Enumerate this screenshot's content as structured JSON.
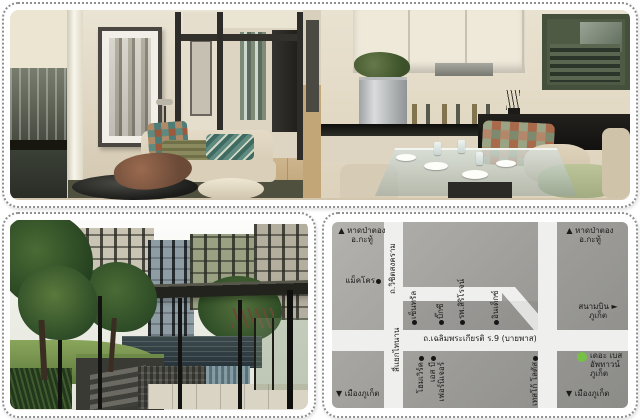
{
  "map": {
    "directions": {
      "top_left": [
        "▲ หาดป่าตอง",
        "อ.กะทู้"
      ],
      "top_right": [
        "▲ หาดป่าตอง",
        "อ.กะทู้"
      ],
      "bottom_left": "▼ เมืองภูเก็ต",
      "bottom_right": "▼ เมืองภูเก็ต",
      "airport": [
        "สนามบิน ►",
        "ภูเก็ต"
      ]
    },
    "roads": {
      "vertical": "ถ.วิชิตสงคราม",
      "main": "ถ.เฉลิมพระเกียรติ ร.9 (บายพาส)",
      "intersection": "สี่แยกไทนาน"
    },
    "poi": {
      "makro": "แม็คโคร",
      "central": "เซ็นทรัล",
      "bigc": "บิ๊กซี",
      "siriroj": "รพ.สิริโรจน์",
      "index": "อินเด็กซ์",
      "homework": "โฮมเวิร์ค",
      "sb_furniture": [
        "เอส บี",
        "เฟอร์นิเจอร์"
      ],
      "tesco": "เทสโก้ โลตัส"
    },
    "project": {
      "name_lines": [
        "เดอะ เบส",
        "อัพทาวน์",
        "ภูเก็ต"
      ],
      "marker_color": "#76c043"
    },
    "colors": {
      "map_background": "#9c9b98",
      "road": "#efefed",
      "text": "#1b1b1b",
      "marker": "#161616"
    }
  }
}
